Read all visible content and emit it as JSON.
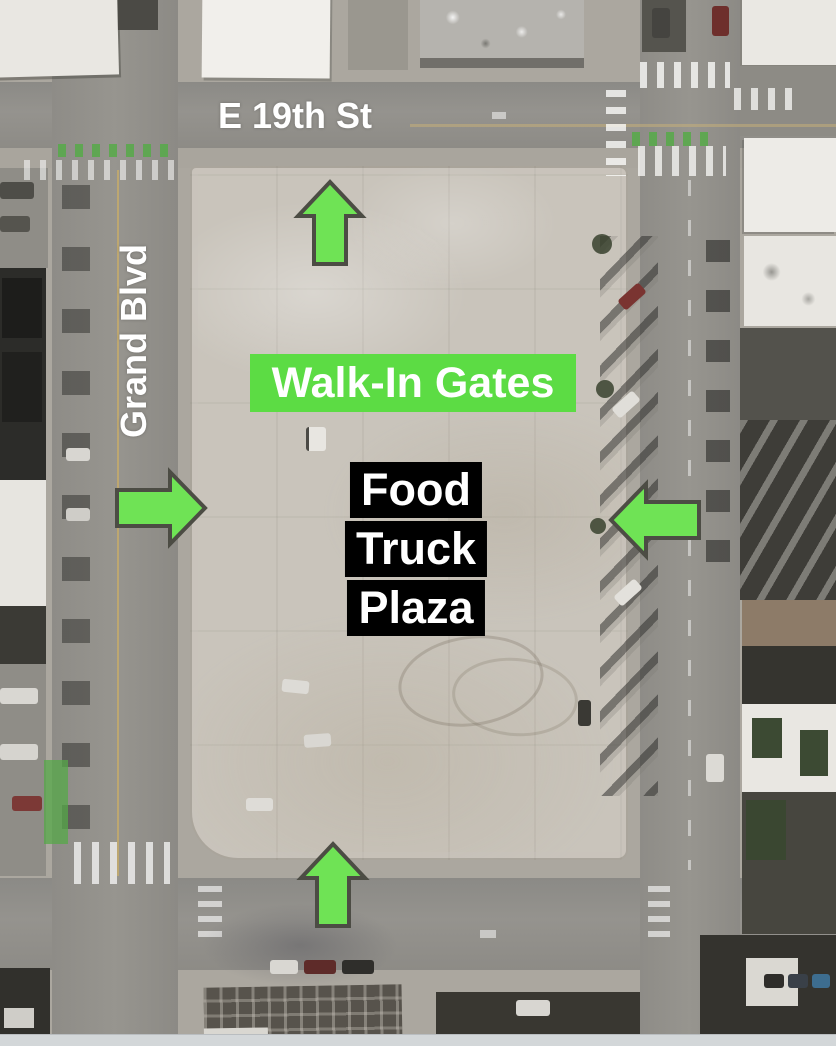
{
  "map": {
    "description": "Aerial satellite view of a parking lot annotated as Food Truck Plaza with walk-in gate entrance arrows",
    "street_labels": [
      {
        "id": "e-19th-st",
        "label": "E 19th St",
        "orientation": "horizontal"
      },
      {
        "id": "grand-blvd",
        "label": "Grand Blvd",
        "orientation": "vertical"
      }
    ],
    "gates_label": "Walk-In Gates",
    "plaza_label_lines": [
      "Food",
      "Truck",
      "Plaza"
    ],
    "arrows": [
      {
        "position": "top",
        "direction": "up",
        "icon": "arrow-up-icon"
      },
      {
        "position": "left",
        "direction": "right",
        "icon": "arrow-right-icon"
      },
      {
        "position": "right",
        "direction": "left",
        "icon": "arrow-left-icon"
      },
      {
        "position": "bottom",
        "direction": "up",
        "icon": "arrow-up-icon"
      }
    ],
    "colors": {
      "arrow_green": "#6FE355",
      "arrow_outline": "#4C4C44",
      "gate_green": "#5CDC44",
      "label_white": "#FFFFFF",
      "plaza_black": "#000000"
    }
  }
}
